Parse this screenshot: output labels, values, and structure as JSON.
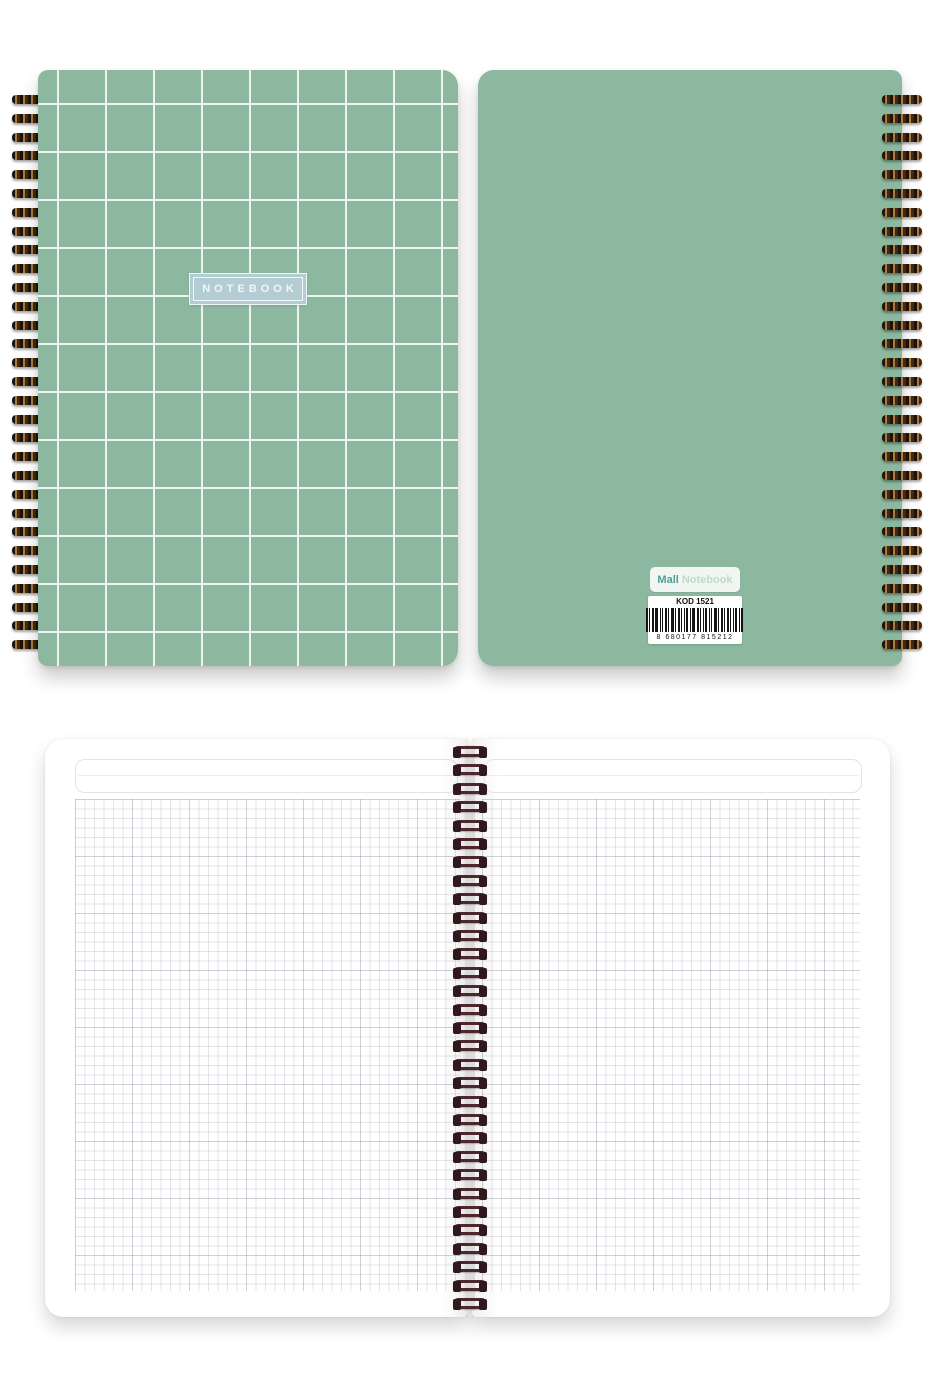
{
  "scene": {
    "description": "Spiral-bound grid notebook product photo: front cover, back cover, open pages",
    "background_color": "#ffffff"
  },
  "front_cover": {
    "label": "NOTEBOOK",
    "cover_color": "#8bb89e",
    "grid_line_color": "#ffffff",
    "label_bg_color": "#b4cdd5",
    "label_text_color": "#f0f6f3"
  },
  "back_cover": {
    "cover_color": "#8bb89e",
    "brand_label": {
      "primary": "Mall",
      "secondary": "Notebook",
      "primary_color": "#4aa293",
      "secondary_color": "#bcdcca"
    },
    "barcode_label": {
      "code": "KOD 1521",
      "number": "8 680177 815212"
    }
  },
  "open_notebook": {
    "page_color": "#ffffff",
    "grid_line_color": "#babac6",
    "spine_color": "#dcdcde",
    "coil_color": "#4c272c"
  },
  "spiral": {
    "cover_coil_count": 30,
    "binding_coil_count": 31
  }
}
